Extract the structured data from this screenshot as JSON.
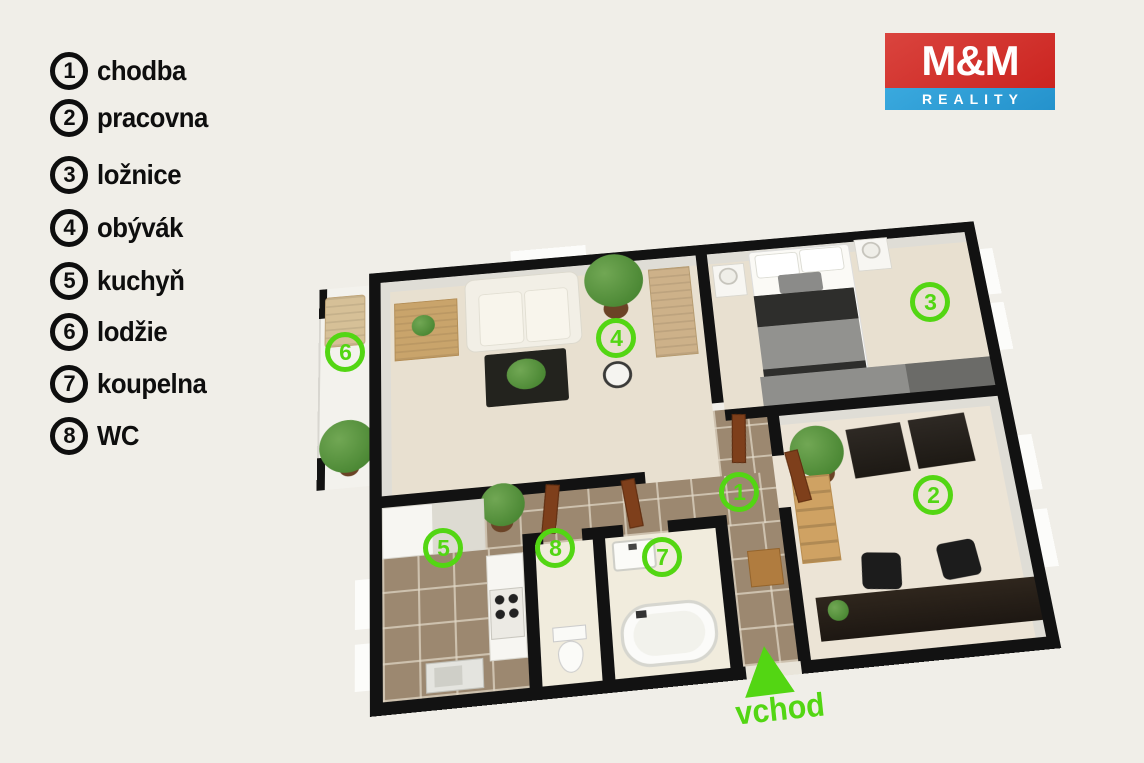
{
  "palette": {
    "background": "#f0eee8",
    "accent_green": "#53d613",
    "wall": "#121212",
    "logo_red": "#cb2420",
    "logo_blue": "#2a9ed6",
    "floor_beige": "#e8e0d0",
    "floor_tile_brown": "#9c8870"
  },
  "legend": {
    "items": [
      {
        "num": "1",
        "label": "chodba"
      },
      {
        "num": "2",
        "label": "pracovna"
      },
      {
        "num": "3",
        "label": "ložnice"
      },
      {
        "num": "4",
        "label": "obývák"
      },
      {
        "num": "5",
        "label": "kuchyň"
      },
      {
        "num": "6",
        "label": "lodžie"
      },
      {
        "num": "7",
        "label": "koupelna"
      },
      {
        "num": "8",
        "label": "WC"
      }
    ]
  },
  "logo": {
    "top": "M&M",
    "bottom": "REALITY"
  },
  "entrance": {
    "label": "vchod"
  }
}
